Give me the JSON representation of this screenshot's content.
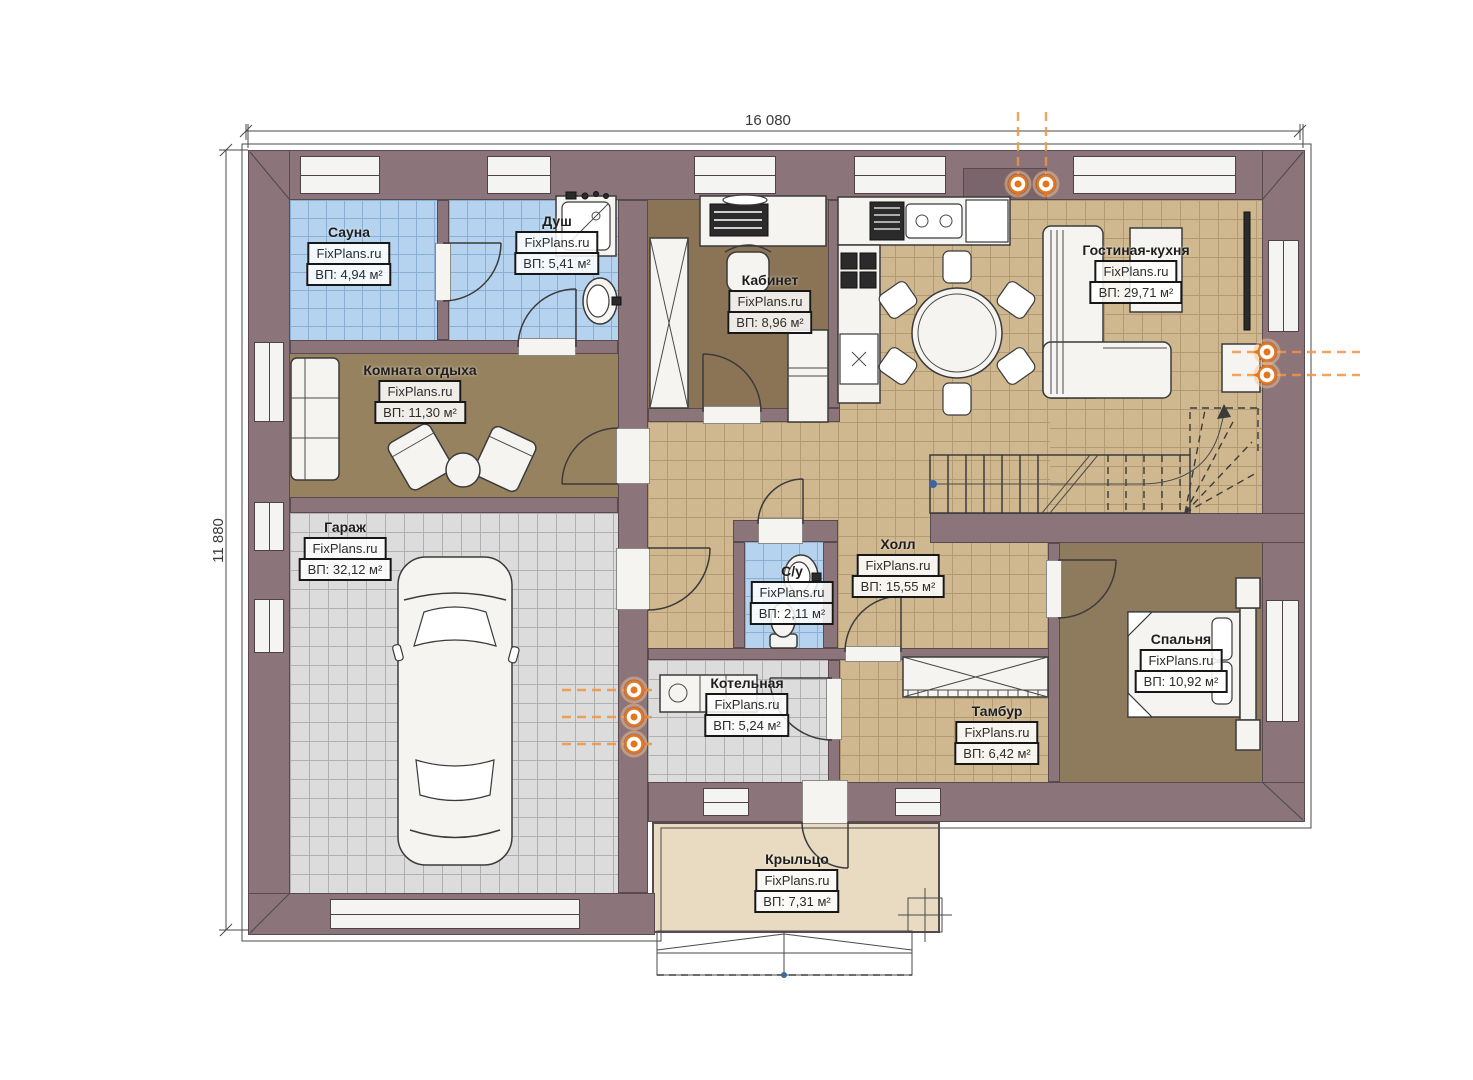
{
  "plan": {
    "type": "architectural-floor-plan",
    "dimensions": {
      "width_label": "16 080",
      "height_label": "11 880"
    },
    "watermark": "FixPlans.ru",
    "rooms": {
      "sauna": {
        "name": "Сауна",
        "watermark": "FixPlans.ru",
        "area": "ВП: 4,94 м²"
      },
      "shower": {
        "name": "Душ",
        "watermark": "FixPlans.ru",
        "area": "ВП: 5,41 м²"
      },
      "office": {
        "name": "Кабинет",
        "watermark": "FixPlans.ru",
        "area": "ВП: 8,96 м²"
      },
      "living_kitchen": {
        "name": "Гостиная-кухня",
        "watermark": "FixPlans.ru",
        "area": "ВП: 29,71 м²"
      },
      "lounge": {
        "name": "Комната отдыха",
        "watermark": "FixPlans.ru",
        "area": "ВП: 11,30 м²"
      },
      "garage": {
        "name": "Гараж",
        "watermark": "FixPlans.ru",
        "area": "ВП: 32,12 м²"
      },
      "hall": {
        "name": "Холл",
        "watermark": "FixPlans.ru",
        "area": "ВП: 15,55 м²"
      },
      "wc": {
        "name": "С/у",
        "watermark": "FixPlans.ru",
        "area": "ВП: 2,11 м²"
      },
      "boiler": {
        "name": "Котельная",
        "watermark": "FixPlans.ru",
        "area": "ВП: 5,24 м²"
      },
      "vestibule": {
        "name": "Тамбур",
        "watermark": "FixPlans.ru",
        "area": "ВП: 6,42 м²"
      },
      "bedroom": {
        "name": "Спальня",
        "watermark": "FixPlans.ru",
        "area": "ВП: 10,92 м²"
      },
      "porch": {
        "name": "Крыльцо",
        "watermark": "FixPlans.ru",
        "area": "ВП: 7,31 м²"
      }
    },
    "colors": {
      "wall": "#8b747a",
      "floor_tan": "#cfb78f",
      "floor_blue": "#b5d3ee",
      "floor_grey": "#dcdcdc",
      "floor_brown": "#97825f",
      "porch": "#e8dbc1",
      "heating_orange": "#e4761f"
    }
  }
}
